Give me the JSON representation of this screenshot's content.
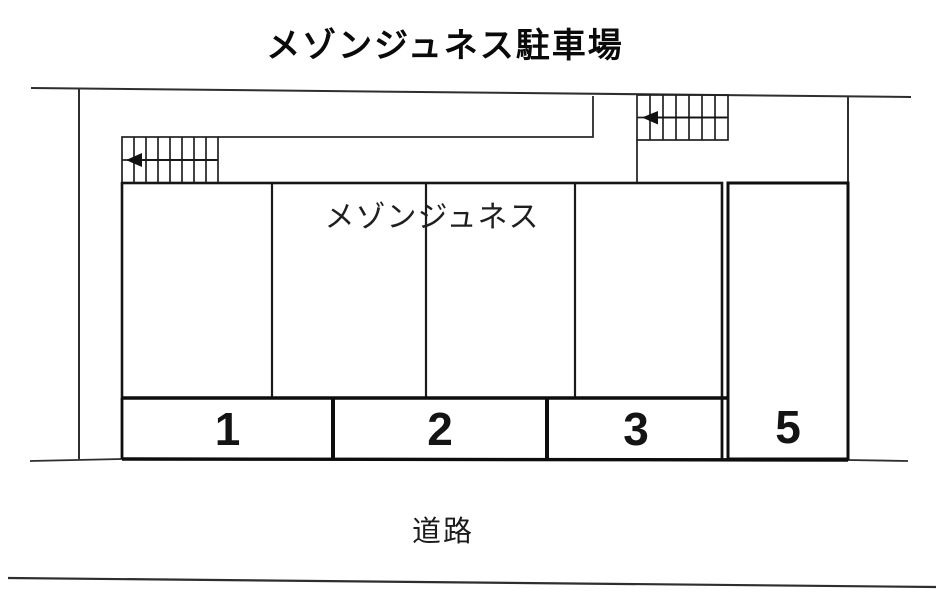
{
  "title": "メゾンジュネス駐車場",
  "building": {
    "label": "メゾンジュネス"
  },
  "road": {
    "label": "道路"
  },
  "parking": {
    "spaces": [
      {
        "number": "1"
      },
      {
        "number": "2"
      },
      {
        "number": "3"
      },
      {
        "number": "5"
      }
    ]
  },
  "icons": {
    "left_staircase_arrow": "left-arrow ◄",
    "right_staircase_arrow": "left-arrow ◄"
  },
  "colors": {
    "ink": "#1a1a1a",
    "heavy_line": "#0d0d0d",
    "background": "#ffffff"
  }
}
